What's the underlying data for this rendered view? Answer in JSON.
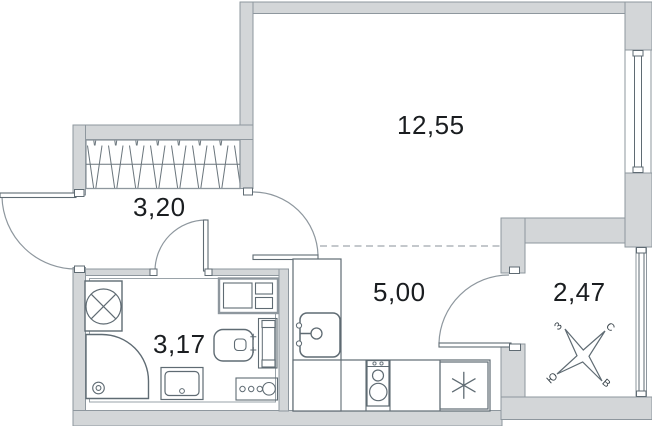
{
  "rooms": {
    "living": {
      "label": "12,55"
    },
    "hallway": {
      "label": "3,20"
    },
    "kitchen": {
      "label": "5,00"
    },
    "bathroom": {
      "label": "3,17"
    },
    "balcony": {
      "label": "2,47"
    }
  },
  "compass": {
    "west": "З",
    "north": "С",
    "south": "Ю",
    "east": "В"
  },
  "colors": {
    "wall_fill": "#d3d6d8",
    "wall_stroke": "#8e979e",
    "line": "#5f6b73",
    "thin_line": "#9aa3a9",
    "dash_line": "#b0b6bb",
    "text": "#1a1d20"
  }
}
